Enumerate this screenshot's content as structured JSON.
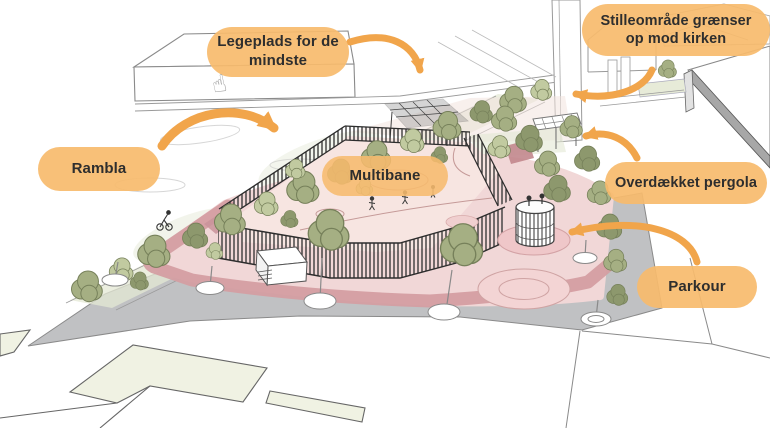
{
  "illustration": {
    "type": "architectural-sketch",
    "description": "Perspective sketch of a playground site plan with annotated areas",
    "labels": [
      {
        "id": "legeplads",
        "text": "Legeplads for de mindste"
      },
      {
        "id": "stilleomraade",
        "text": "Stilleområde grænser op mod kirken"
      },
      {
        "id": "rambla",
        "text": "Rambla"
      },
      {
        "id": "multibane",
        "text": "Multibane"
      },
      {
        "id": "pergola",
        "text": "Overdækket pergola"
      },
      {
        "id": "parkour",
        "text": "Parkour"
      }
    ],
    "cursor_icon": {
      "name": "hand-cursor-icon",
      "glyph": "☝"
    },
    "colors": {
      "label_bubble": "#F7BB6D",
      "label_text": "#2E2E2E",
      "arrow": "#F1A54B",
      "court_pink": "#F7E5E1",
      "platform_pink": "#F1D7D7",
      "apron_rose": "#D49EA2",
      "pavement_gray": "#C0C1C3",
      "tree_olive": "#A5AF83",
      "building_cream": "#F0F2E3",
      "sketch_line": "#8A8A8A"
    }
  }
}
